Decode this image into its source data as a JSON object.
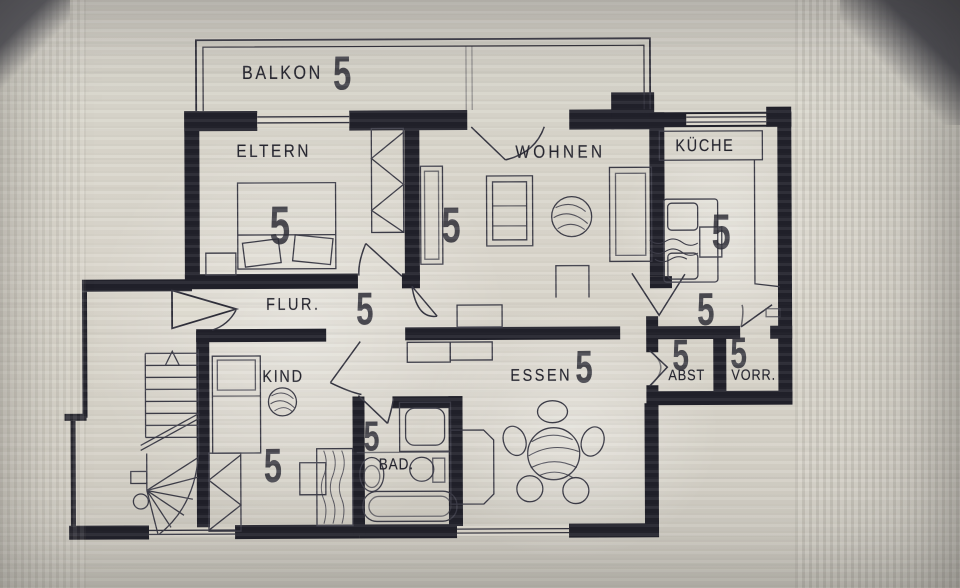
{
  "plan_title": "Wohnungsgrundriss",
  "labels": {
    "balkon": "BALKON",
    "eltern": "ELTERN",
    "wohnen": "WOHNEN",
    "kueche": "KÜCHE",
    "flur": "FLUR.",
    "kind": "KIND",
    "bad": "BAD.",
    "essen": "ESSEN",
    "abst": "ABST",
    "vorr": "VORR."
  },
  "marks": {
    "balkon": "5",
    "eltern": "5",
    "wohnen": "5",
    "kueche_upper": "5",
    "kueche_lower": "5",
    "flur": "5",
    "kind": "5",
    "bad": "5",
    "essen": "5",
    "abst": "5",
    "vorr": "5"
  },
  "colors": {
    "ink": "#23232d",
    "wall": "#1e1e28",
    "paper": "#d7d3c8"
  }
}
